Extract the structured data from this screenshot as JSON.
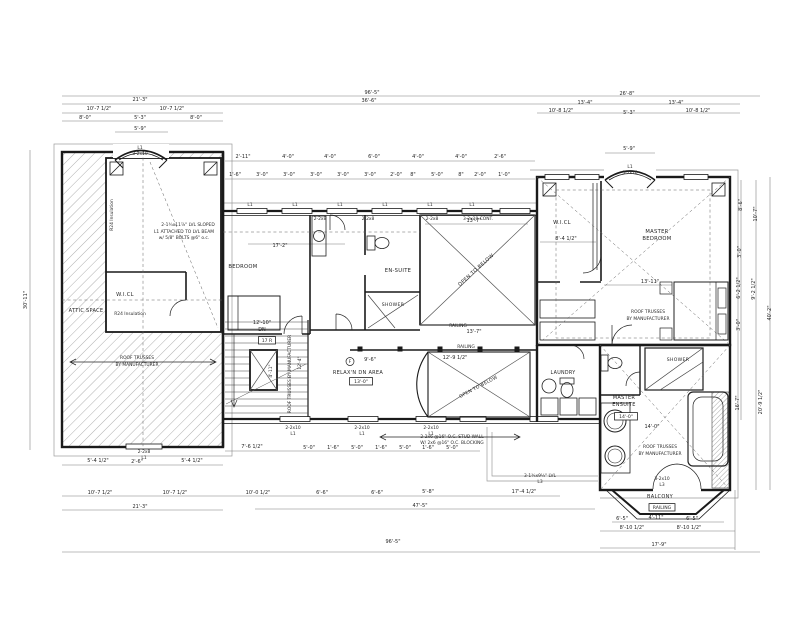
{
  "plan": {
    "colors": {
      "ink": "#1a1a1a",
      "dim_line": "#7a7a7a",
      "hatch": "#9a9a9a",
      "background": "#ffffff"
    },
    "rooms": [
      {
        "t": "ATTIC SPACE",
        "x": 86,
        "y": 312,
        "fs": 5
      },
      {
        "t": "W.I.CL",
        "x": 125,
        "y": 296,
        "fs": 5.2
      },
      {
        "t": "BEDROOM",
        "x": 243,
        "y": 268,
        "fs": 5.2
      },
      {
        "t": "EN-SUITE",
        "x": 398,
        "y": 272,
        "fs": 5.2
      },
      {
        "t": "SHOWER",
        "x": 393,
        "y": 306,
        "fs": 4.6
      },
      {
        "t": "RELAX'N DN AREA",
        "x": 358,
        "y": 374,
        "fs": 5
      },
      {
        "t": "W.I.CL",
        "x": 562,
        "y": 224,
        "fs": 5.2
      },
      {
        "t": "MASTER",
        "x": 657,
        "y": 233,
        "fs": 5.2
      },
      {
        "t": "BEDROOM",
        "x": 657,
        "y": 240,
        "fs": 5.2
      },
      {
        "t": "LAUNDRY",
        "x": 563,
        "y": 374,
        "fs": 4.8
      },
      {
        "t": "MASTER",
        "x": 624,
        "y": 399,
        "fs": 5
      },
      {
        "t": "ENSUITE",
        "x": 624,
        "y": 406,
        "fs": 5
      },
      {
        "t": "SHOWER",
        "x": 678,
        "y": 361,
        "fs": 4.6
      },
      {
        "t": "BALCONY",
        "x": 660,
        "y": 498,
        "fs": 5
      },
      {
        "t": "OPEN TO BELOW",
        "x": 477,
        "y": 271,
        "fs": 5,
        "r": -42
      },
      {
        "t": "OPEN TO BELOW",
        "x": 479,
        "y": 388,
        "fs": 4.6,
        "r": -28
      }
    ],
    "boxed_labels": [
      {
        "t": "17 R",
        "x": 267,
        "y": 342
      },
      {
        "t": "13'-0\"",
        "x": 361,
        "y": 383
      },
      {
        "t": "14'-0\"",
        "x": 626,
        "y": 418
      },
      {
        "t": "RAILING",
        "x": 662,
        "y": 509
      }
    ],
    "notes": [
      {
        "t": "ROOF TRUSSES",
        "x": 137,
        "y": 359
      },
      {
        "t": "BY MANUFACTURER",
        "x": 137,
        "y": 366
      },
      {
        "t": "ROOF TRUSSES",
        "x": 648,
        "y": 313
      },
      {
        "t": "BY MANUFACTURER",
        "x": 648,
        "y": 320
      },
      {
        "t": "ROOF TRUSSES",
        "x": 660,
        "y": 448
      },
      {
        "t": "BY MANUFACTURER",
        "x": 660,
        "y": 455
      },
      {
        "t": "ROOF TRUSSES BY MANUFACTURER",
        "x": 291,
        "y": 374,
        "r": -90
      },
      {
        "t": "R24 Insulation",
        "x": 113,
        "y": 215,
        "r": -90
      },
      {
        "t": "R24 Insulation",
        "x": 130,
        "y": 315
      },
      {
        "t": "2-1¾x11⅞\" LVL SLOPED",
        "x": 188,
        "y": 226
      },
      {
        "t": "L1 ATTACHED TO LVL BEAM",
        "x": 184,
        "y": 233
      },
      {
        "t": "w/ 5/8\" BOLTS @6\" o.c.",
        "x": 184,
        "y": 239
      },
      {
        "t": "2-2x6 @16\" O.C. STUD WALL",
        "x": 452,
        "y": 438
      },
      {
        "t": "W/ 2x6 @16\" O.C. BLOCKING",
        "x": 452,
        "y": 444
      },
      {
        "t": "3-1¾x9½\" LVL",
        "x": 540,
        "y": 477
      },
      {
        "t": "L3",
        "x": 540,
        "y": 483
      },
      {
        "t": "RAILING",
        "x": 458,
        "y": 327
      },
      {
        "t": "RAILING",
        "x": 466,
        "y": 348
      },
      {
        "t": "3-2x10",
        "x": 662,
        "y": 480
      },
      {
        "t": "L3",
        "x": 662,
        "y": 486
      },
      {
        "t": "2-2x10",
        "x": 293,
        "y": 429
      },
      {
        "t": "L1",
        "x": 293,
        "y": 435
      },
      {
        "t": "2-2x10",
        "x": 362,
        "y": 429
      },
      {
        "t": "L1",
        "x": 362,
        "y": 435
      },
      {
        "t": "2-2x10",
        "x": 431,
        "y": 429
      },
      {
        "t": "L1",
        "x": 431,
        "y": 435
      },
      {
        "t": "2-2x8",
        "x": 320,
        "y": 220
      },
      {
        "t": "2-2x8",
        "x": 368,
        "y": 220
      },
      {
        "t": "2-2x8",
        "x": 432,
        "y": 220
      },
      {
        "t": "3-2x10 CONT.",
        "x": 478,
        "y": 220
      },
      {
        "t": "L1",
        "x": 250,
        "y": 206
      },
      {
        "t": "L1",
        "x": 295,
        "y": 206
      },
      {
        "t": "L1",
        "x": 340,
        "y": 206
      },
      {
        "t": "L1",
        "x": 385,
        "y": 206
      },
      {
        "t": "L1",
        "x": 430,
        "y": 206
      },
      {
        "t": "L1",
        "x": 472,
        "y": 206
      },
      {
        "t": "L1",
        "x": 140,
        "y": 149
      },
      {
        "t": "3-2x10",
        "x": 140,
        "y": 155
      },
      {
        "t": "L1",
        "x": 630,
        "y": 168
      },
      {
        "t": "3-2x10",
        "x": 630,
        "y": 174
      },
      {
        "t": "2-2x8",
        "x": 144,
        "y": 453
      },
      {
        "t": "L1",
        "x": 144,
        "y": 459
      },
      {
        "t": "F",
        "x": 350,
        "y": 363
      },
      {
        "t": "4'-11\"",
        "x": 272,
        "y": 371,
        "r": -90
      },
      {
        "t": "12'-4\"",
        "x": 301,
        "y": 363,
        "r": -90
      }
    ],
    "dims": [
      {
        "t": "96'-5\"",
        "x": 372,
        "y": 94
      },
      {
        "t": "21'-3\"",
        "x": 140,
        "y": 101
      },
      {
        "t": "36'-6\"",
        "x": 369,
        "y": 102
      },
      {
        "t": "26'-8\"",
        "x": 627,
        "y": 95
      },
      {
        "t": "10'-7 1/2\"",
        "x": 99,
        "y": 110
      },
      {
        "t": "10'-7 1/2\"",
        "x": 172,
        "y": 110
      },
      {
        "t": "8'-0\"",
        "x": 85,
        "y": 119
      },
      {
        "t": "5'-3\"",
        "x": 140,
        "y": 119
      },
      {
        "t": "8'-0\"",
        "x": 196,
        "y": 119
      },
      {
        "t": "5'-9\"",
        "x": 140,
        "y": 130
      },
      {
        "t": "13'-4\"",
        "x": 585,
        "y": 104
      },
      {
        "t": "13'-4\"",
        "x": 676,
        "y": 104
      },
      {
        "t": "10'-8 1/2\"",
        "x": 561,
        "y": 112
      },
      {
        "t": "5'-3\"",
        "x": 629,
        "y": 114
      },
      {
        "t": "10'-8 1/2\"",
        "x": 698,
        "y": 112
      },
      {
        "t": "5'-9\"",
        "x": 629,
        "y": 150
      },
      {
        "t": "2'-11\"",
        "x": 243,
        "y": 158
      },
      {
        "t": "4'-0\"",
        "x": 288,
        "y": 158
      },
      {
        "t": "4'-0\"",
        "x": 330,
        "y": 158
      },
      {
        "t": "6'-0\"",
        "x": 374,
        "y": 158
      },
      {
        "t": "4'-0\"",
        "x": 418,
        "y": 158
      },
      {
        "t": "4'-0\"",
        "x": 461,
        "y": 158
      },
      {
        "t": "2'-6\"",
        "x": 500,
        "y": 158
      },
      {
        "t": "1'-6\"",
        "x": 235,
        "y": 176
      },
      {
        "t": "3'-0\"",
        "x": 262,
        "y": 176
      },
      {
        "t": "3'-0\"",
        "x": 289,
        "y": 176
      },
      {
        "t": "3'-0\"",
        "x": 316,
        "y": 176
      },
      {
        "t": "3'-0\"",
        "x": 343,
        "y": 176
      },
      {
        "t": "3'-0\"",
        "x": 370,
        "y": 176
      },
      {
        "t": "2'-0\"",
        "x": 396,
        "y": 176
      },
      {
        "t": "8\"",
        "x": 413,
        "y": 176
      },
      {
        "t": "5'-0\"",
        "x": 437,
        "y": 176
      },
      {
        "t": "8\"",
        "x": 461,
        "y": 176
      },
      {
        "t": "2'-0\"",
        "x": 480,
        "y": 176
      },
      {
        "t": "1'-0\"",
        "x": 504,
        "y": 176
      },
      {
        "t": "30'-11\"",
        "x": 27,
        "y": 300,
        "r": -90
      },
      {
        "t": "40'-2\"",
        "x": 771,
        "y": 313,
        "r": -90
      },
      {
        "t": "10'-7\"",
        "x": 757,
        "y": 214,
        "r": -90
      },
      {
        "t": "9'-2 1/2\"",
        "x": 755,
        "y": 289,
        "r": -90
      },
      {
        "t": "20'-9 1/2\"",
        "x": 762,
        "y": 402,
        "r": -90
      },
      {
        "t": "8'-6\"",
        "x": 742,
        "y": 205,
        "r": -90
      },
      {
        "t": "3'-0\"",
        "x": 741,
        "y": 252,
        "r": -90
      },
      {
        "t": "6'-2 1/2\"",
        "x": 740,
        "y": 288,
        "r": -90
      },
      {
        "t": "3'-0\"",
        "x": 740,
        "y": 325,
        "r": -90
      },
      {
        "t": "16'-7\"",
        "x": 739,
        "y": 403,
        "r": -90
      },
      {
        "t": "5'-4 1/2\"",
        "x": 98,
        "y": 462
      },
      {
        "t": "2'-6\"",
        "x": 137,
        "y": 463
      },
      {
        "t": "5'-4 1/2\"",
        "x": 192,
        "y": 462
      },
      {
        "t": "7'-6 1/2\"",
        "x": 252,
        "y": 448
      },
      {
        "t": "5'-0\"",
        "x": 309,
        "y": 449
      },
      {
        "t": "1'-6\"",
        "x": 333,
        "y": 449
      },
      {
        "t": "5'-0\"",
        "x": 357,
        "y": 449
      },
      {
        "t": "1'-6\"",
        "x": 381,
        "y": 449
      },
      {
        "t": "5'-0\"",
        "x": 405,
        "y": 449
      },
      {
        "t": "1'-6\"",
        "x": 428,
        "y": 449
      },
      {
        "t": "5'-0\"",
        "x": 452,
        "y": 449
      },
      {
        "t": "10'-7 1/2\"",
        "x": 100,
        "y": 494
      },
      {
        "t": "10'-7 1/2\"",
        "x": 175,
        "y": 494
      },
      {
        "t": "10'-0 1/2\"",
        "x": 258,
        "y": 494
      },
      {
        "t": "6'-6\"",
        "x": 322,
        "y": 494
      },
      {
        "t": "6'-6\"",
        "x": 377,
        "y": 494
      },
      {
        "t": "5'-8\"",
        "x": 428,
        "y": 493
      },
      {
        "t": "17'-4 1/2\"",
        "x": 524,
        "y": 493
      },
      {
        "t": "21'-3\"",
        "x": 140,
        "y": 508
      },
      {
        "t": "47'-5\"",
        "x": 420,
        "y": 507
      },
      {
        "t": "96'-5\"",
        "x": 393,
        "y": 543
      },
      {
        "t": "6'-5\"",
        "x": 622,
        "y": 520
      },
      {
        "t": "4'-11\"",
        "x": 656,
        "y": 519
      },
      {
        "t": "6'-5\"",
        "x": 692,
        "y": 520
      },
      {
        "t": "8'-10 1/2\"",
        "x": 632,
        "y": 529
      },
      {
        "t": "8'-10 1/2\"",
        "x": 689,
        "y": 529
      },
      {
        "t": "17'-9\"",
        "x": 659,
        "y": 546
      },
      {
        "t": "17'-2\"",
        "x": 280,
        "y": 247
      },
      {
        "t": "13'-7\"",
        "x": 474,
        "y": 222
      },
      {
        "t": "13'-7\"",
        "x": 474,
        "y": 333
      },
      {
        "t": "12'-9 1/2\"",
        "x": 455,
        "y": 359
      },
      {
        "t": "12'-10\"",
        "x": 262,
        "y": 324
      },
      {
        "t": "DN",
        "x": 262,
        "y": 331
      },
      {
        "t": "13'-11\"",
        "x": 650,
        "y": 283
      },
      {
        "t": "8'-4 1/2\"",
        "x": 566,
        "y": 240
      },
      {
        "t": "14'-0\"",
        "x": 652,
        "y": 428
      },
      {
        "t": "9'-6\"",
        "x": 370,
        "y": 361
      }
    ]
  }
}
